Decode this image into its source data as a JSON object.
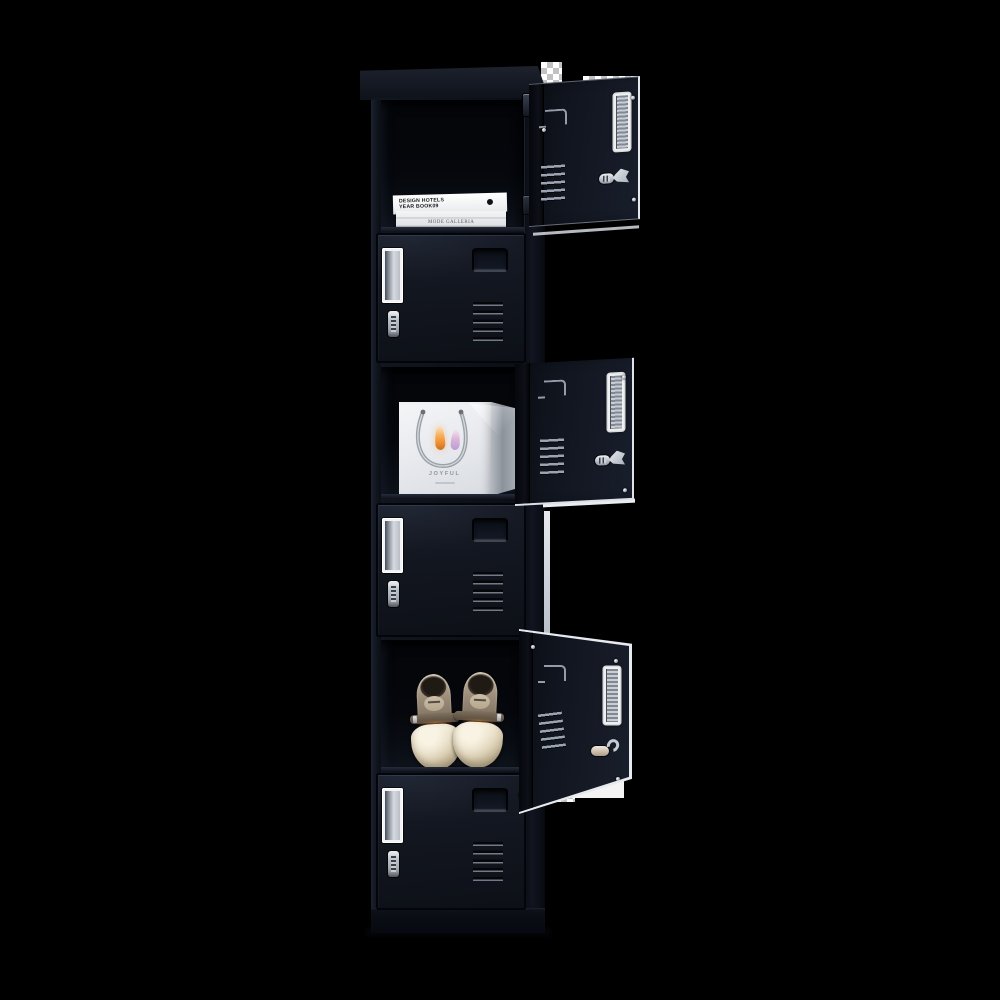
{
  "image": {
    "type": "product-photo",
    "subject": "6-door vertical black metal storage locker, three compartments open and styled with props",
    "background_color": "#000000"
  },
  "locker": {
    "body_color": "#11151e",
    "hardware_color": "#c9ced6",
    "door_features": [
      "vertical label holder",
      "cam lock",
      "ventilation slots",
      "recessed handle"
    ],
    "compartments": [
      {
        "id": 1,
        "state": "open",
        "contents": "stack of white books"
      },
      {
        "id": 2,
        "state": "closed",
        "contents": ""
      },
      {
        "id": 3,
        "state": "open",
        "contents": "white gift bag with candle-flame print"
      },
      {
        "id": 4,
        "state": "closed",
        "contents": ""
      },
      {
        "id": 5,
        "state": "open",
        "contents": "pair of beige ankle-strap heels"
      },
      {
        "id": 6,
        "state": "closed",
        "contents": ""
      }
    ]
  },
  "books": {
    "line1": "DESIGN HOTELS",
    "line2": "YEAR BOOK09",
    "spine2": "MODE GALLERIA"
  },
  "gift_bag": {
    "label": "JOYFUL"
  }
}
